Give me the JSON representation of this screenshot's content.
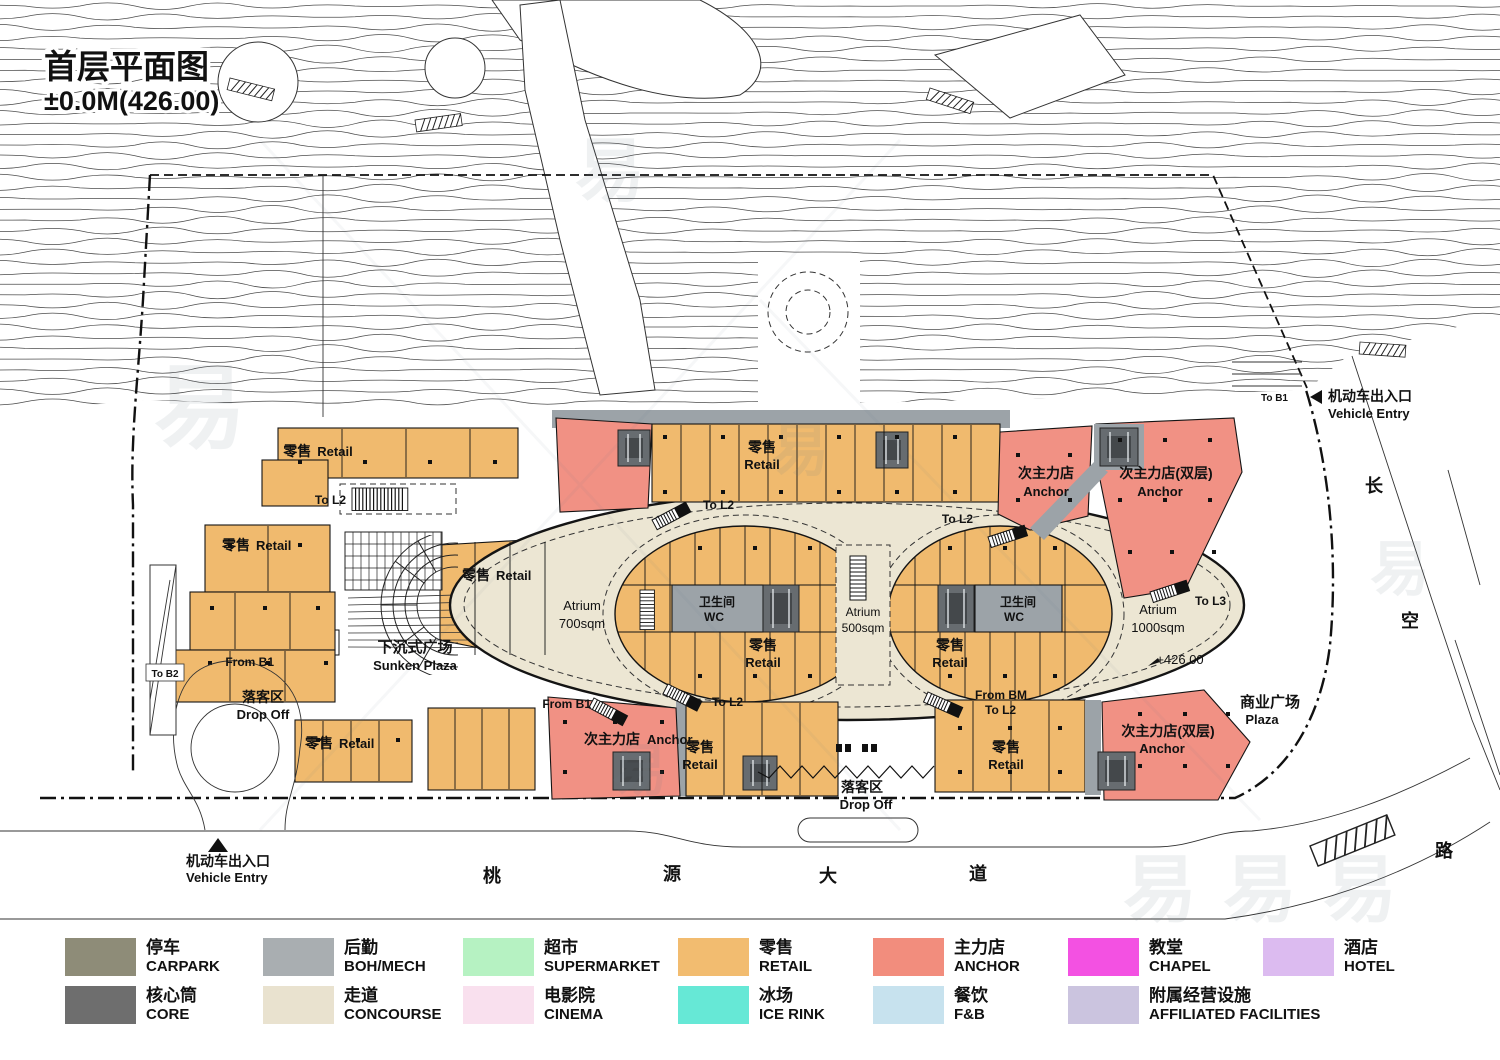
{
  "title": {
    "name": "首层平面图",
    "level": "±0.0M(426.00)"
  },
  "plan": {
    "labels": {
      "retail_zh": "零售",
      "retail_en": "Retail",
      "anchor_zh": "次主力店",
      "anchor_en": "Anchor",
      "anchor2_zh": "次主力店(双层)",
      "wc_zh": "卫生间",
      "wc_en": "WC",
      "atrium": "Atrium",
      "a700": "700sqm",
      "a500": "500sqm",
      "a1000": "1000sqm",
      "level_mark": "+426.00",
      "to_l2": "To L2",
      "to_l3": "To L3",
      "to_b1": "To B1",
      "to_b2": "To B2",
      "from_b1": "From B1",
      "from_bm": "From BM",
      "sunken_zh": "下沉式广场",
      "sunken_en": "Sunken Plaza",
      "dropoff_zh": "落客区",
      "dropoff_en": "Drop Off",
      "plaza_zh": "商业广场",
      "plaza_en": "Plaza",
      "ventry_zh": "机动车出入口",
      "ventry_en": "Vehicle Entry"
    },
    "streets": {
      "east": [
        "长",
        "空",
        "路"
      ],
      "south": [
        "桃",
        "源",
        "大",
        "道"
      ]
    },
    "watermark": "易"
  },
  "legend": {
    "items": [
      {
        "zh": "停车",
        "en": "CARPARK",
        "color": "#8e8c78"
      },
      {
        "zh": "核心筒",
        "en": "CORE",
        "color": "#6e6e6e"
      },
      {
        "zh": "后勤",
        "en": "BOH/MECH",
        "color": "#a9aeb1"
      },
      {
        "zh": "走道",
        "en": "CONCOURSE",
        "color": "#e9e2cf"
      },
      {
        "zh": "超市",
        "en": "SUPERMARKET",
        "color": "#b6f2c2"
      },
      {
        "zh": "电影院",
        "en": "CINEMA",
        "color": "#f9e0ee"
      },
      {
        "zh": "零售",
        "en": "RETAIL",
        "color": "#f2bc70"
      },
      {
        "zh": "冰场",
        "en": "ICE RINK",
        "color": "#66e8d6"
      },
      {
        "zh": "主力店",
        "en": "ANCHOR",
        "color": "#f28d7d"
      },
      {
        "zh": "餐饮",
        "en": "F&B",
        "color": "#c7e2ee"
      },
      {
        "zh": "教堂",
        "en": "CHAPEL",
        "color": "#f351e2"
      },
      {
        "zh": "附属经营设施",
        "en": "AFFILIATED FACILITIES",
        "color": "#cbc4df"
      },
      {
        "zh": "酒店",
        "en": "HOTEL",
        "color": "#dcbbf0"
      }
    ]
  }
}
